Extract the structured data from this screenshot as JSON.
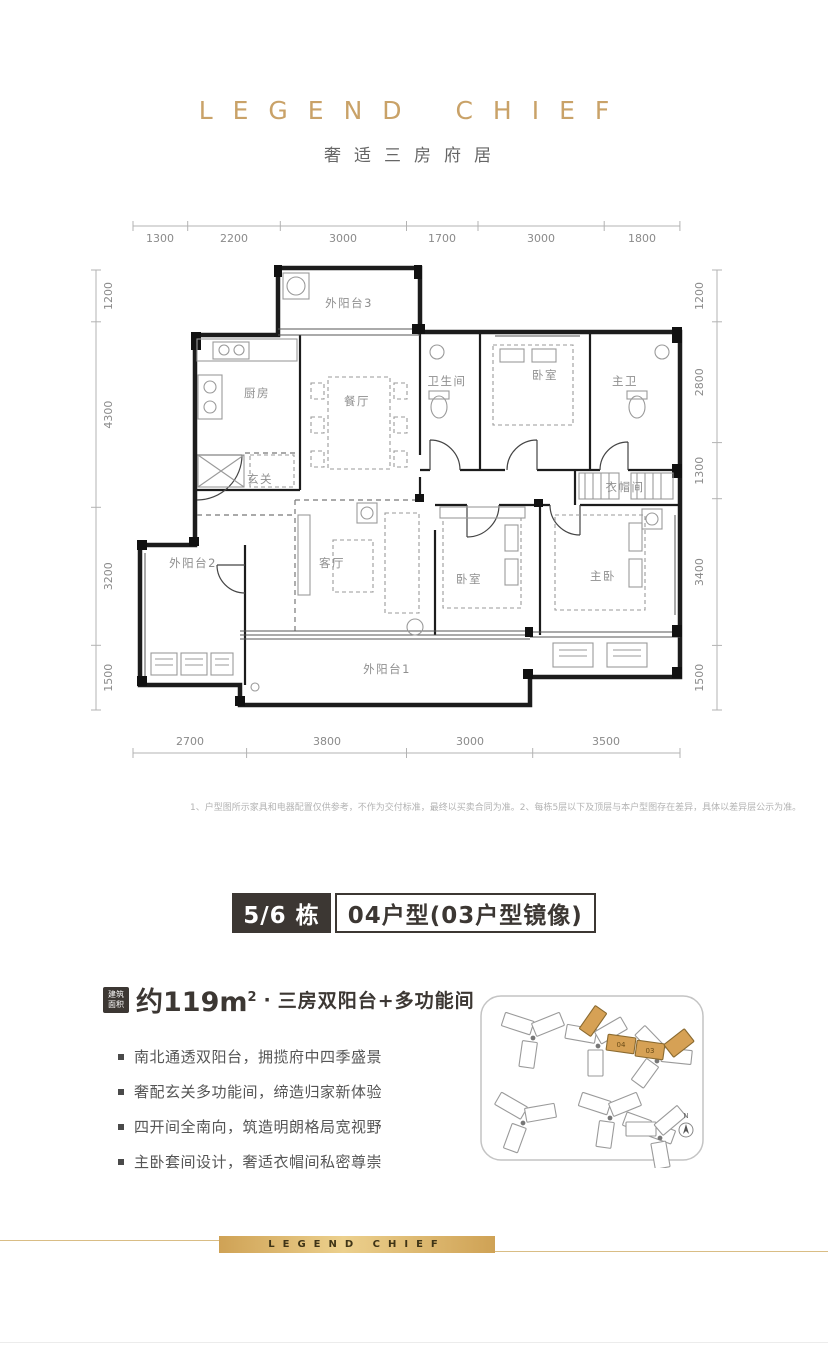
{
  "header": {
    "brand": "LEGEND CHIEF",
    "subtitle": "奢适三房府居"
  },
  "plan": {
    "dims_top": [
      "1300",
      "2200",
      "3000",
      "1700",
      "3000",
      "1800"
    ],
    "dims_bottom": [
      "2700",
      "3800",
      "3000",
      "3500"
    ],
    "dims_left": [
      "1200",
      "4300",
      "3200",
      "1500"
    ],
    "dims_right": [
      "1200",
      "2800",
      "1300",
      "3400",
      "1500"
    ],
    "rooms": [
      {
        "label": "外阳台3"
      },
      {
        "label": "厨房"
      },
      {
        "label": "餐厅"
      },
      {
        "label": "卫生间"
      },
      {
        "label": "卧室"
      },
      {
        "label": "主卫"
      },
      {
        "label": "玄关"
      },
      {
        "label": "衣帽间"
      },
      {
        "label": "外阳台2"
      },
      {
        "label": "客厅"
      },
      {
        "label": "卧室"
      },
      {
        "label": "主卧"
      },
      {
        "label": "外阳台1"
      }
    ]
  },
  "disclaimer": "1、户型图所示家具和电器配置仅供参考，不作为交付标准，最终以买卖合同为准。2、每栋5层以下及顶层与本户型图存在差异，具体以差异层公示为准。",
  "banner": {
    "building": "5/6 栋",
    "unit": "04户型(03户型镜像)"
  },
  "summary": {
    "tag_line1": "建筑",
    "tag_line2": "面积",
    "area": "约119m",
    "area_sup": "2",
    "separator": "·",
    "desc": "三房双阳台+多功能间"
  },
  "features": {
    "items": [
      "南北通透双阳台，拥揽府中四季盛景",
      "奢配玄关多功能间，缔造归家新体验",
      "四开间全南向，筑造明朗格局宽视野",
      "主卧套间设计，奢适衣帽间私密尊崇"
    ]
  },
  "sitemap": {
    "unit_labels": [
      "04",
      "03"
    ],
    "north": "N",
    "highlight_color": "#d6a155"
  },
  "footer": {
    "brand": "LEGEND CHIEF"
  },
  "colors": {
    "gold": "#c9a268",
    "dark": "#3c3733"
  }
}
